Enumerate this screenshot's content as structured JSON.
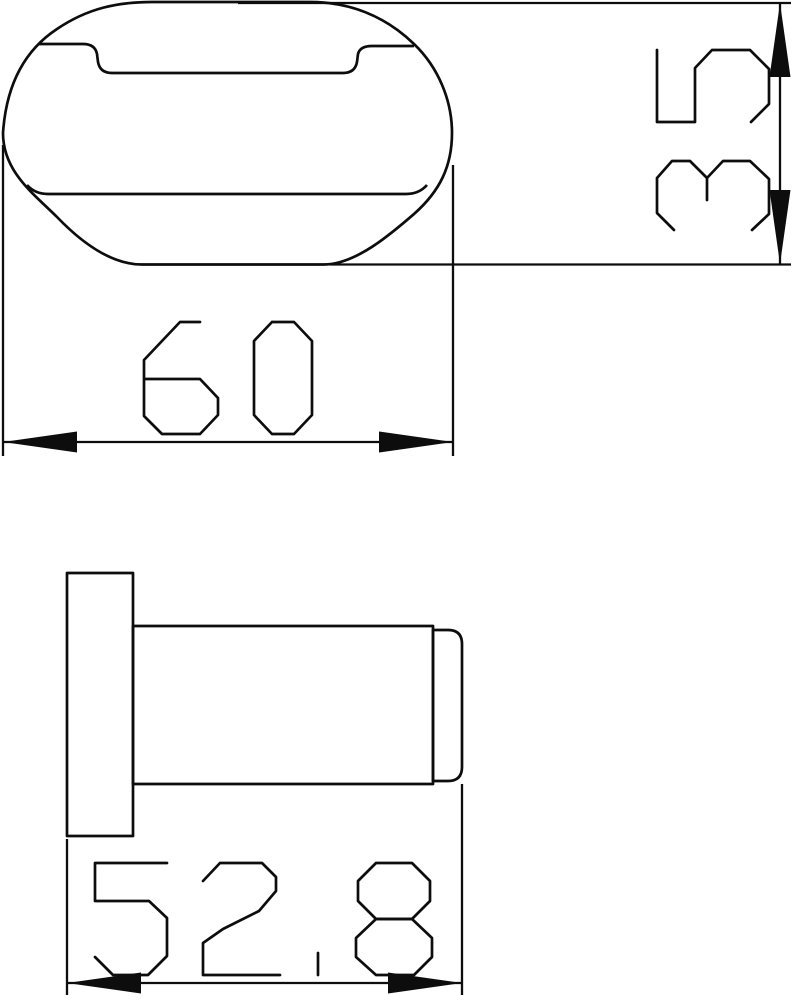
{
  "drawing": {
    "background": "#ffffff",
    "line_color": "#0d0d0d",
    "views": {
      "top_view": {
        "label": "hook face top view"
      },
      "side_view": {
        "label": "hook side view"
      }
    },
    "dimensions": {
      "width": {
        "value": "60",
        "orientation": "horizontal",
        "applies_to": "top view overall width"
      },
      "height": {
        "value": "35",
        "orientation": "vertical",
        "applies_to": "top view overall height"
      },
      "depth": {
        "value": "52.8",
        "orientation": "horizontal",
        "applies_to": "side view overall depth"
      }
    }
  }
}
